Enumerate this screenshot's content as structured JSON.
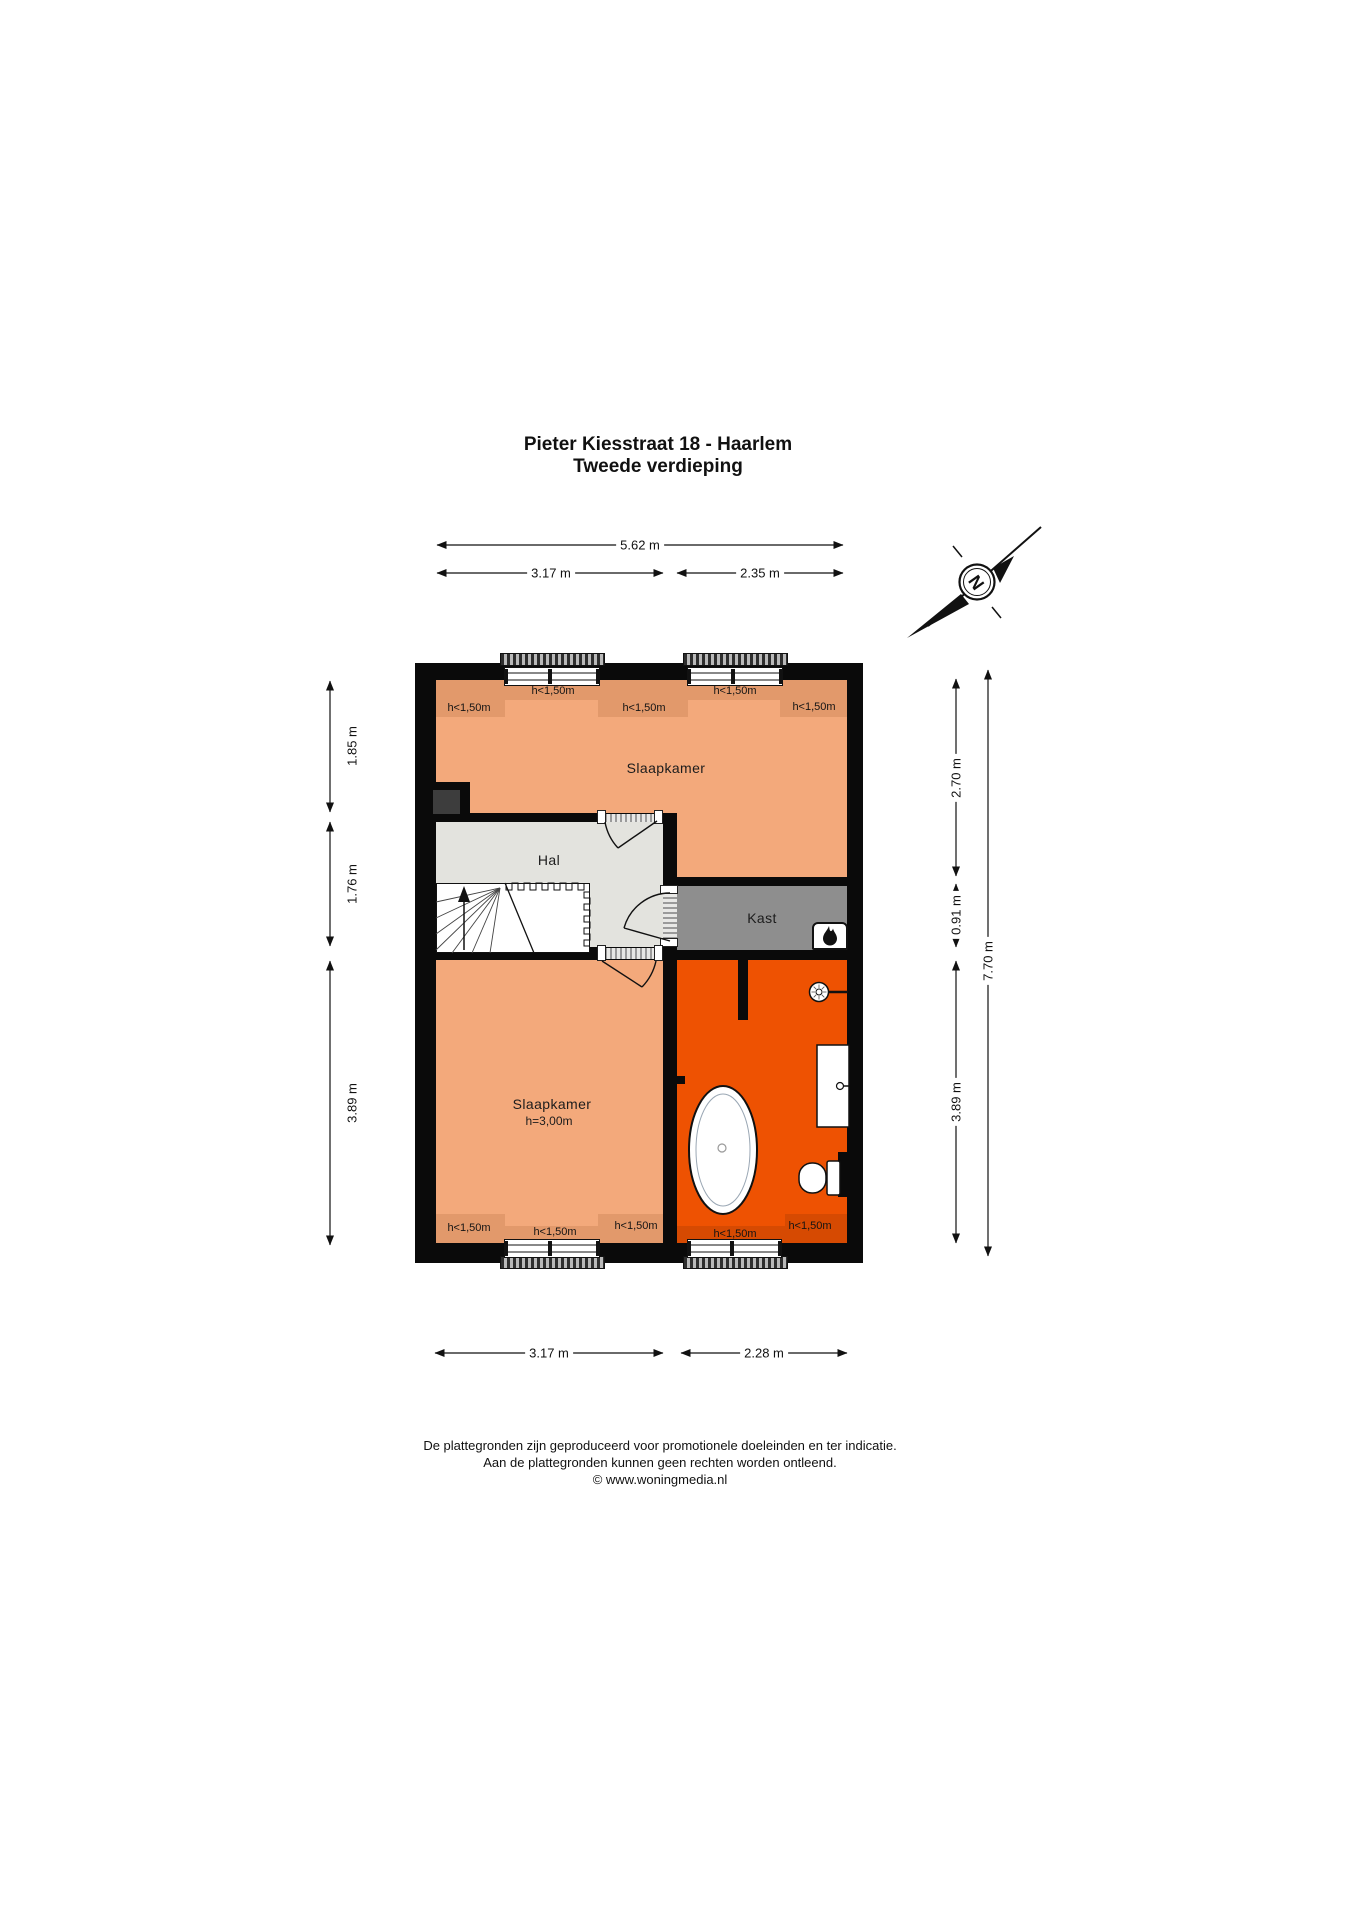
{
  "title": {
    "line1": "Pieter Kiesstraat 18 - Haarlem",
    "line2": "Tweede verdieping"
  },
  "compass": {
    "letter": "N"
  },
  "dimensions": {
    "top_total": "5.62 m",
    "top_left": "3.17 m",
    "top_right": "2.35 m",
    "bottom_left": "3.17 m",
    "bottom_right": "2.28 m",
    "left_segments": [
      "1.85 m",
      "1.76 m",
      "3.89 m"
    ],
    "right_segments": [
      "2.70 m",
      "0.91 m",
      "3.89 m"
    ],
    "right_total": "7.70 m"
  },
  "rooms": {
    "bedroom_top": {
      "name": "Slaapkamer"
    },
    "hall": {
      "name": "Hal"
    },
    "closet": {
      "name": "Kast"
    },
    "bedroom_bottom": {
      "name": "Slaapkamer",
      "height": "h=3,00m"
    }
  },
  "annotations": {
    "low_headroom": "h<1,50m"
  },
  "footer": {
    "line1": "De plattegronden zijn geproduceerd voor promotionele doeleinden en ter indicatie.",
    "line2": "Aan de plattegronden kunnen geen rechten worden ontleend.",
    "line3": "© www.woningmedia.nl"
  },
  "colors": {
    "bedroom_fill": "#F3A97B",
    "bedroom_low_band": "#E2996B",
    "bathroom_fill": "#EE5202",
    "bathroom_low_band": "#D64A02",
    "hall_fill": "#E3E3DE",
    "closet_fill": "#8E8E8E",
    "wall": "#0A0A0A",
    "chimney": "#3D3D3D"
  }
}
